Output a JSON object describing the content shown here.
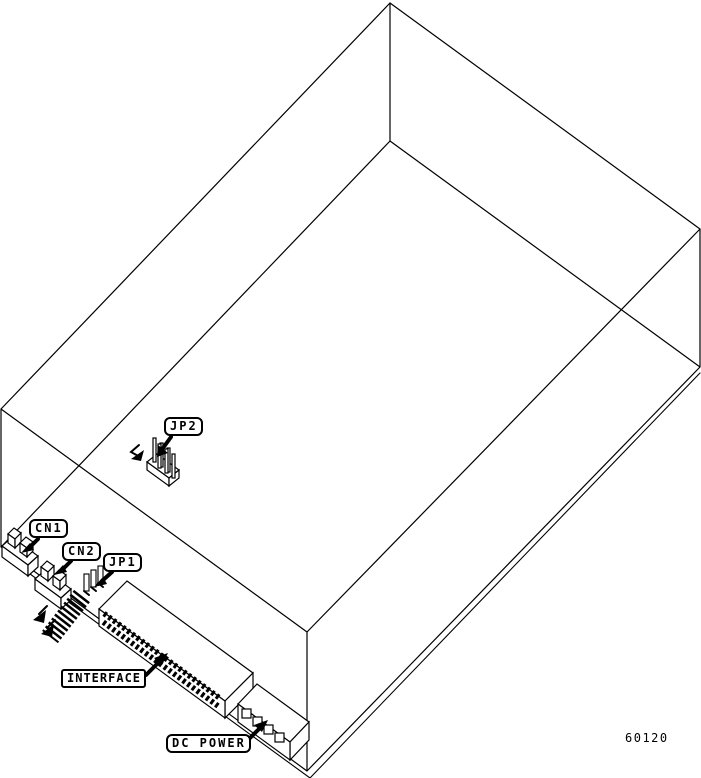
{
  "diagram": {
    "background_color": "#ffffff",
    "line_color": "#000000",
    "part_number": "60120",
    "callouts": {
      "jp2": "JP2",
      "cn1": "CN1",
      "cn2": "CN2",
      "jp1": "JP1",
      "interface": "INTERFACE",
      "dc_power": "DC POWER"
    }
  }
}
